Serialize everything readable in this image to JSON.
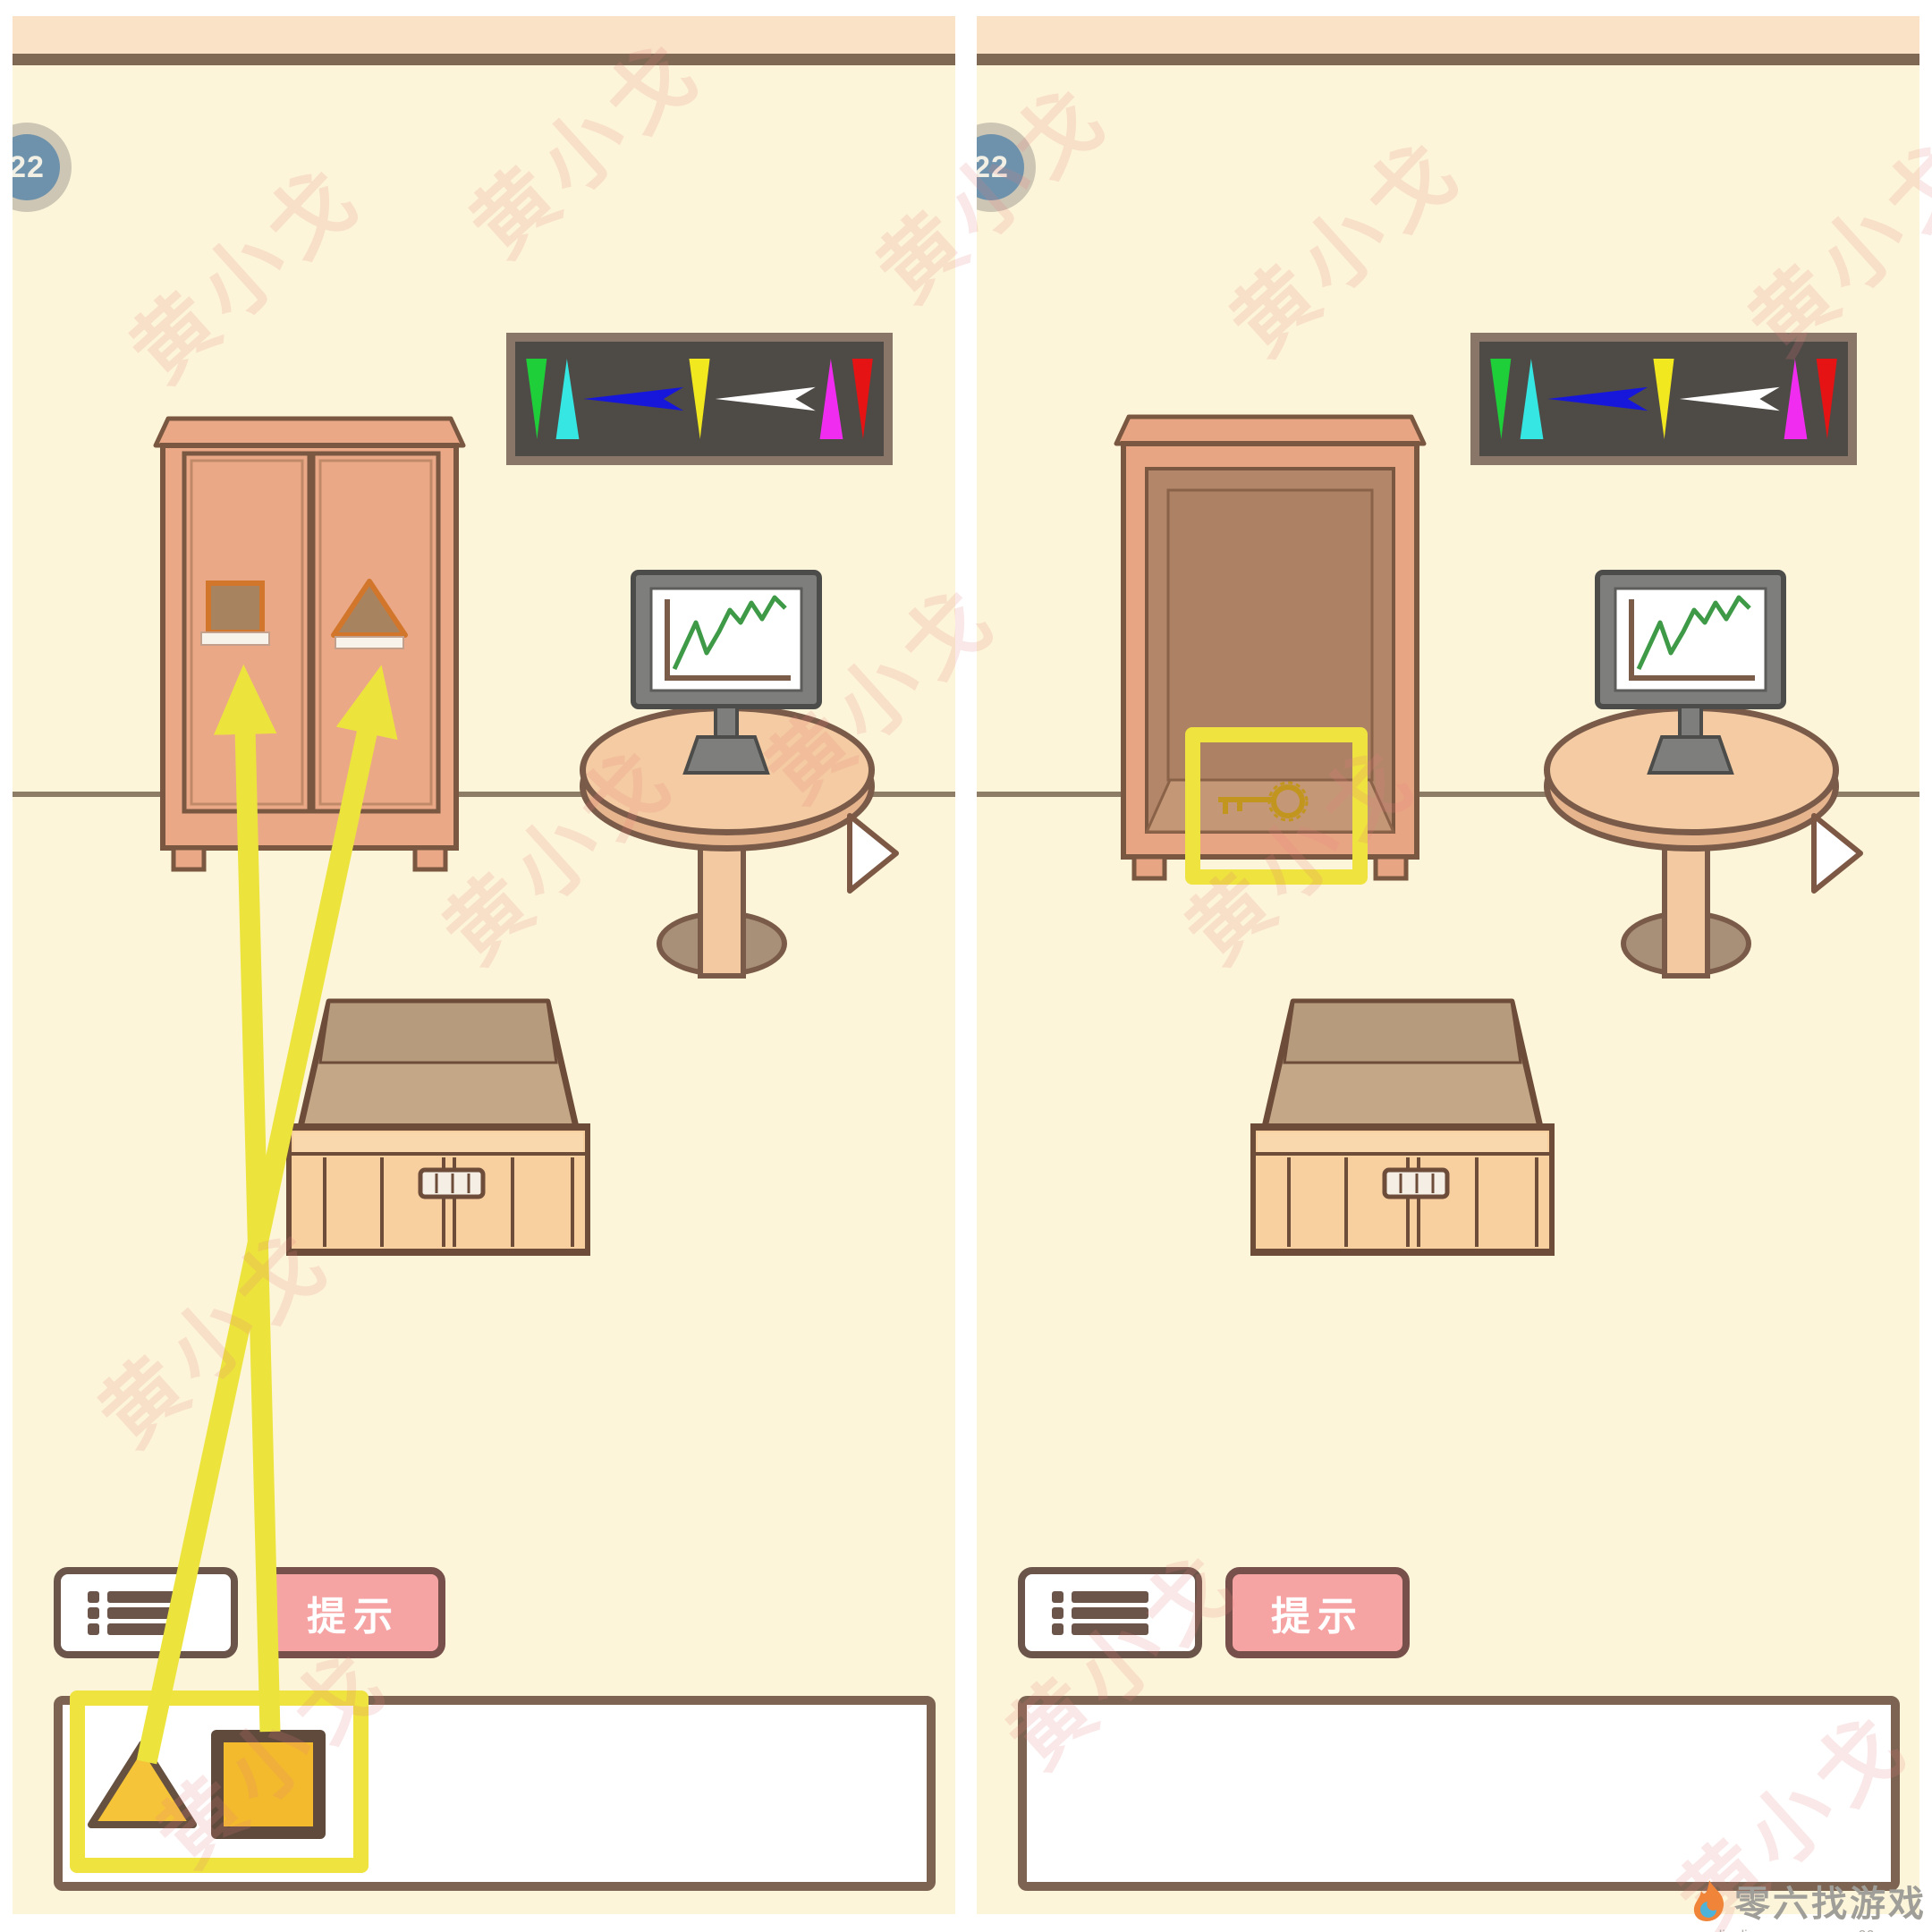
{
  "level_badge": {
    "value": "22"
  },
  "toolbar": {
    "menu_icon": "list-icon",
    "hint_label": "提示"
  },
  "banner": {
    "bg_color": "#4e4a46",
    "frame_color": "#8a7668",
    "arrows": [
      {
        "name": "green-down-arrow",
        "color": "#1fcf3a",
        "direction": "down"
      },
      {
        "name": "cyan-up-arrow",
        "color": "#35e6e2",
        "direction": "up"
      },
      {
        "name": "blue-left-arrow",
        "color": "#1717dc",
        "direction": "left"
      },
      {
        "name": "yellow-down-arrow",
        "color": "#f2e81f",
        "direction": "down"
      },
      {
        "name": "white-left-arrow",
        "color": "#ffffff",
        "direction": "left"
      },
      {
        "name": "magenta-up-arrow",
        "color": "#ef2cef",
        "direction": "up"
      },
      {
        "name": "red-down-arrow",
        "color": "#e51313",
        "direction": "down"
      }
    ]
  },
  "panels": {
    "left": {
      "wardrobe_state": "closed",
      "door_slots": [
        "square",
        "triangle"
      ],
      "inventory_items": [
        "triangle",
        "square"
      ],
      "annotations": [
        "yellow-box-around-inventory-items",
        "arrow-triangle-item-to-right-door",
        "arrow-square-item-to-left-door"
      ]
    },
    "right": {
      "wardrobe_state": "open",
      "wardrobe_contents": [
        "gold-key"
      ],
      "inventory_items": [],
      "annotations": [
        "yellow-box-around-key"
      ]
    }
  },
  "colors": {
    "room_bg": "#fcf5d9",
    "wall_trim": "#7f6954",
    "wardrobe": "#eba887",
    "wardrobe_interior": "#b3866a",
    "slot_accent": "#d2762c",
    "table": "#f4cba2",
    "monitor_frame": "#7e7e7c",
    "chart_line": "#3f9a48",
    "box_front": "#f8cf9f",
    "hint_pink": "#f5a3a3",
    "annotation_yellow": "#efe33f",
    "item_gold": "#f2ba2c",
    "key_gold": "#c2961e",
    "badge_blue": "#6e92ac"
  },
  "watermark": {
    "text": "黄小戈"
  },
  "footer": {
    "logo_icon": "flame-icon",
    "logo_text": "零六找游戏",
    "url_left": "www.lingliuyx.com",
    "url_right": "www.06zyx.com"
  }
}
